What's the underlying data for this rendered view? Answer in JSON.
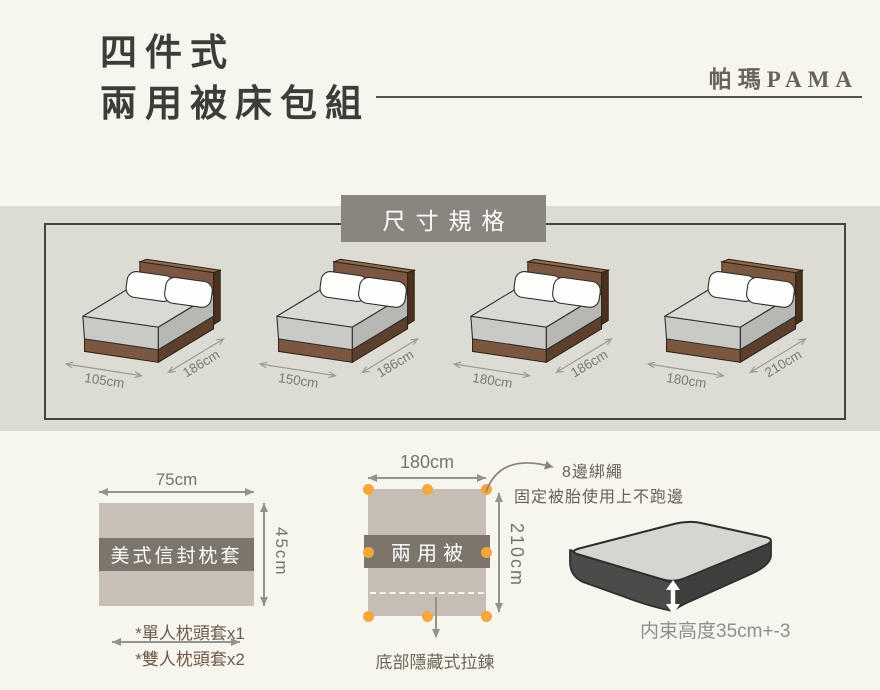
{
  "header": {
    "title_line1": "四件式",
    "title_line2": "兩用被床包組",
    "brand": "帕瑪PAMA"
  },
  "size_section": {
    "heading": "尺寸規格",
    "beds": [
      {
        "width": "105cm",
        "length": "186cm"
      },
      {
        "width": "150cm",
        "length": "186cm"
      },
      {
        "width": "180cm",
        "length": "186cm"
      },
      {
        "width": "180cm",
        "length": "210cm"
      }
    ]
  },
  "pillowcase": {
    "width_label": "75cm",
    "height_label": "45cm",
    "name": "美式信封枕套",
    "note1": "*單人枕頭套x1",
    "note2": "*雙人枕頭套x2"
  },
  "duvet": {
    "width_label": "180cm",
    "height_label": "210cm",
    "name": "兩用被",
    "tie_count": 8,
    "tie_note_title": "8邊綁繩",
    "tie_note_desc": "固定被胎使用上不跑邊",
    "zipper_note": "底部隱藏式拉鍊"
  },
  "mattress": {
    "depth_note": "内束高度35cm+-3"
  },
  "colors": {
    "page_bg": "#f6f5ee",
    "panel_bg": "#dcdcd4",
    "heading_box": "#8b8580",
    "label_band": "#7b756c",
    "fabric": "#c8bfb6",
    "tie_dot": "#f4a73e",
    "bed_wood": "#7b5741",
    "note_brown": "#6f5b49"
  }
}
